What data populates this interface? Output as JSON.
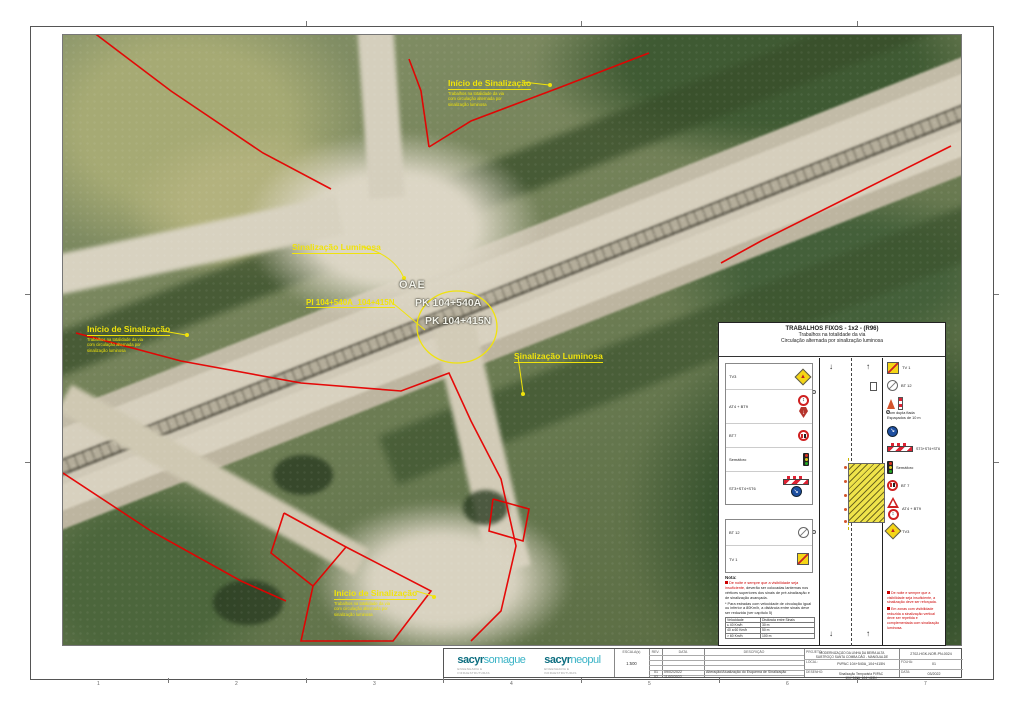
{
  "sheet": {
    "grid_refs": [
      "1",
      "2",
      "3",
      "4",
      "5",
      "6",
      "7"
    ]
  },
  "icons": {
    "warning_triangle": "▲",
    "two_way": "↕",
    "down_arrow": "↓",
    "up_arrow": "↑",
    "keep_right": "↘"
  },
  "map": {
    "start_top": {
      "title": "Início de Sinalização",
      "l1": "Trabalhos na totalidade da via",
      "l2": "com circulação alternada por",
      "l3": "sinalização luminosa"
    },
    "start_left": {
      "title": "Início de Sinalização",
      "l1": "Trabalhos na totalidade da via",
      "l2": "com circulação alternada por",
      "l3": "sinalização luminosa"
    },
    "start_bottom": {
      "title": "Início de Sinalização",
      "l1": "Trabalhos na totalidade da via",
      "l2": "com circulação alternada por",
      "l3": "sinalização luminosa"
    },
    "lum_mid": "Sinalização Luminosa",
    "lum_right": "Sinalização Luminosa",
    "pi_label": "PI 104+540A_104+415N",
    "oae": "OAE",
    "pk_a": "PK 104+540A",
    "pk_b": "PK 104+415N"
  },
  "panel": {
    "title": "TRABALHOS FIXOS - 1x2 - (R96)",
    "sub1": "Trabalhos na totalidade da via",
    "sub2": "Circulação alternada por sinalização luminosa",
    "left": [
      {
        "label": "TV3"
      },
      {
        "label": "AT4 + BT9"
      },
      {
        "label": "BT7"
      },
      {
        "label": "Semáforo"
      },
      {
        "label": "ST3+ST4+ST6"
      }
    ],
    "left_end": [
      {
        "label": "BT 12"
      },
      {
        "label": "TV 1"
      }
    ],
    "right_start": [
      {
        "label": "TV 1"
      },
      {
        "label": "BT 12"
      }
    ],
    "cone_note1": "Com dupla fiada",
    "cone_note2": "Espaçados de 10 m",
    "right": [
      {
        "label": "ST3+ST4+ST6"
      },
      {
        "label": "Semáforo"
      },
      {
        "label": "BT 7"
      },
      {
        "label": "AT4 + BT9"
      },
      {
        "label": "TV3"
      }
    ],
    "nota_title": "Nota:",
    "nota_red": "De noite e sempre que a visibilidade seja insuficiente,",
    "nota_black": "deverão ser colocadas lanternas nos vértices superiores dos sinais de pré-sinalização e de sinalização avançada.",
    "footnote": "* Para estradas com velocidade de circulação igual ou inferior a 80Km/h, a distância entre sinais deve ser reduzida (ver capítulo 5)",
    "tbl_h1": "Velocidade",
    "tbl_h2": "Distância entre Sinais",
    "tbl_rows": [
      [
        "≤ 40 Km/h",
        "30 m"
      ],
      [
        "40 a 60 Km/h",
        "50 m"
      ],
      [
        "> 60 Km/h",
        "100 m"
      ]
    ],
    "nota_r1": "De noite e sempre que a visibilidade seja insuficiente, a sinalização deve ser reforçada.",
    "nota_r2": "Em zonas com visibilidade reduzida a sinalização vertical deve ser repetida e complementada com sinalização luminosa."
  },
  "titleblock": {
    "logo1_brand": "sacyr",
    "logo1_name": "somague",
    "logo1_tag1": "ENGENHARIA E",
    "logo1_tag2": "INFRAESTRUTURAS",
    "logo2_brand": "sacyr",
    "logo2_name": "neopul",
    "logo2_tag1": "ENGENHARIA E",
    "logo2_tag2": "INFRAESTRUTURAS",
    "escala_label": "ESCALA(s)",
    "escala": "1:500",
    "rev_label": "REV.",
    "data_label": "DATA",
    "desc_label": "DESCRIÇÃO",
    "rev1": "01",
    "rev1_date": "09/02/2022",
    "rev1_desc": "Alteração/Atualização do Esquema de Sinalização",
    "rev2": "02",
    "rev2_date": "11/03/2022",
    "rev2_desc": "",
    "projeto_label": "PROJETO:",
    "projeto1": "MODERNIZAÇÃO DA LINHA DA BEIRA ALTA",
    "projeto2": "SUBTROÇO SANTA COMBA DÃO - MANGUALDE",
    "local_label": "LOCAL:",
    "local": "PI/PAC 104+540A_104+415N",
    "desenho_label": "DESENHO:",
    "desenho": "Sinalização Temporária PI/PAC 104+540A_104+415N",
    "doc_number": "2702-HGK-NOR-PN-0024",
    "folha_label": "FOLHA:",
    "folha": "01",
    "data2_label": "DATA:",
    "data2": "03/2022"
  }
}
